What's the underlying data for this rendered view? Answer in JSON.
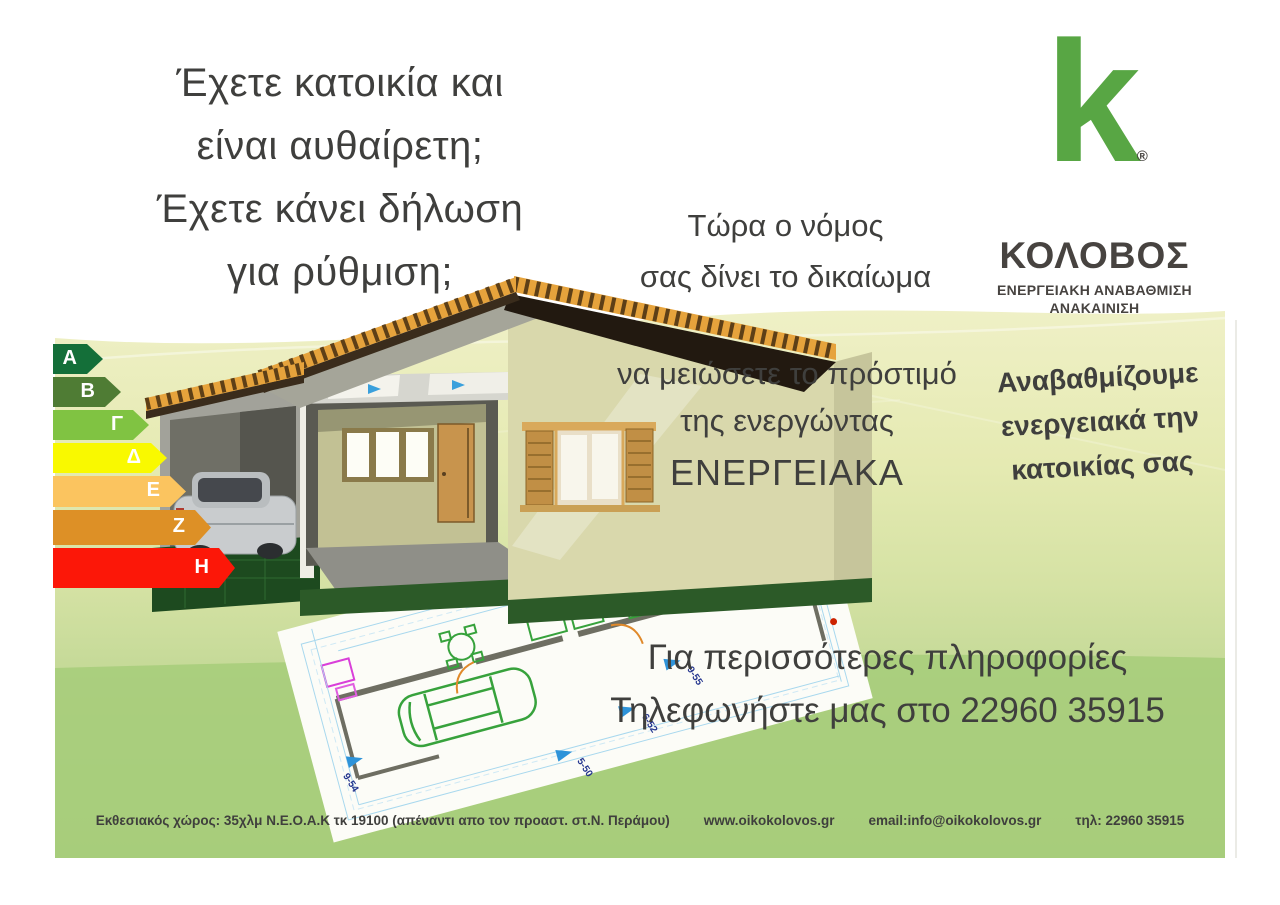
{
  "poster": {
    "headline": {
      "lines": [
        "Έχετε κατοικία και",
        "είναι αυθαίρετη;",
        "Έχετε κάνει δήλωση",
        "για ρύθμιση;"
      ]
    },
    "law_intro": {
      "lines": [
        "Τώρα ο νόμος",
        "σας δίνει το δικαίωμα"
      ]
    },
    "benefit": {
      "lines": [
        "να μειώσετε το πρόστιμό",
        "της ενεργώντας"
      ],
      "emphasis": "ΕΝΕΡΓΕΙΑΚΑ"
    },
    "upgrade_pitch": {
      "lines": [
        "Αναβαθμίζουμε",
        "ενεργειακά την",
        "κατοικίας σας"
      ]
    },
    "contact": {
      "lines": [
        "Για περισσότερες πληροφορίες",
        "Τηλεφωνήστε μας στο 22960 35915"
      ]
    },
    "footer": {
      "address": "Εκθεσιακός χώρος: 35χλμ Ν.Ε.Ο.Α.Κ τκ 19100 (απέναντι απο τον προαστ. στ.Ν. Περάμου)",
      "website": "www.oikokolovos.gr",
      "email": "email:info@oikokolovos.gr",
      "phone": "τηλ: 22960 35915"
    }
  },
  "logo": {
    "mark": "k",
    "registered": "®",
    "company": "ΚΟΛΟΒΟΣ",
    "tagline_line1": "ΕΝΕΡΓΕΙΑΚΗ ΑΝΑΒΑΘΜΙΣΗ",
    "tagline_line2": "ΑΝΑΚΑΙΝΙΣΗ",
    "brand_green": "#58a644",
    "brand_dark": "#474340"
  },
  "energy_scale": {
    "ratings": [
      {
        "label": "Α",
        "color": "#146f39",
        "width": 50,
        "height": 30
      },
      {
        "label": "Β",
        "color": "#4f7c34",
        "width": 68,
        "height": 30
      },
      {
        "label": "Γ",
        "color": "#80c342",
        "width": 96,
        "height": 30
      },
      {
        "label": "Δ",
        "color": "#f9f900",
        "width": 114,
        "height": 30
      },
      {
        "label": "Ε",
        "color": "#fbc45f",
        "width": 133,
        "height": 31
      },
      {
        "label": "Ζ",
        "color": "#dd9026",
        "width": 158,
        "height": 35
      },
      {
        "label": "Η",
        "color": "#fc1708",
        "width": 182,
        "height": 40
      }
    ]
  },
  "floor_plan": {
    "markers": [
      {
        "label": "9-54"
      },
      {
        "label": "5-50"
      },
      {
        "label": "6-52"
      },
      {
        "label": "9-55"
      },
      {
        "label": "16-9"
      },
      {
        "label": "9-59"
      }
    ]
  },
  "colors": {
    "text_dark": "#3f3f3d",
    "band_top": "#eff0c6",
    "band_bottom": "#a6cd7b",
    "marker_blue": "#2e93d9",
    "roof_orange": "#e6a33c",
    "wall_cream": "#d9d8ac"
  }
}
